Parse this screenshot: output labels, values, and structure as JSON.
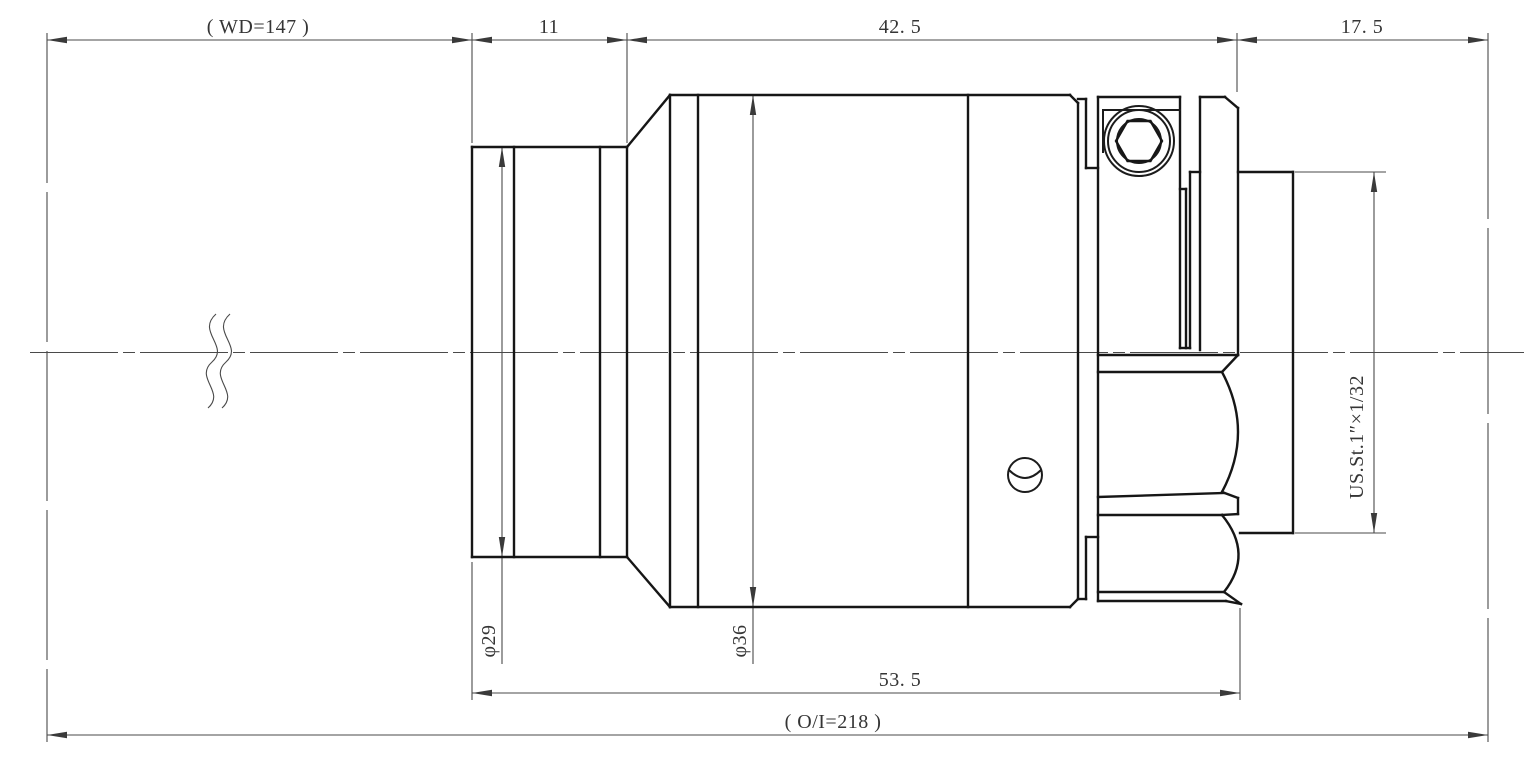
{
  "drawing": {
    "background_color": "#ffffff",
    "outline_color": "#161616",
    "dimension_line_color": "#4a4a4a",
    "labels": {
      "working_distance": "( WD=147 )",
      "front_section_length": "11",
      "body_section_length": "42. 5",
      "flange_distance": "17. 5",
      "front_diameter": "φ29",
      "body_diameter": "φ36",
      "barrel_length": "53. 5",
      "object_image_distance": "( O/I=218 )",
      "mount_thread": "US.St.1″×1/32"
    }
  }
}
